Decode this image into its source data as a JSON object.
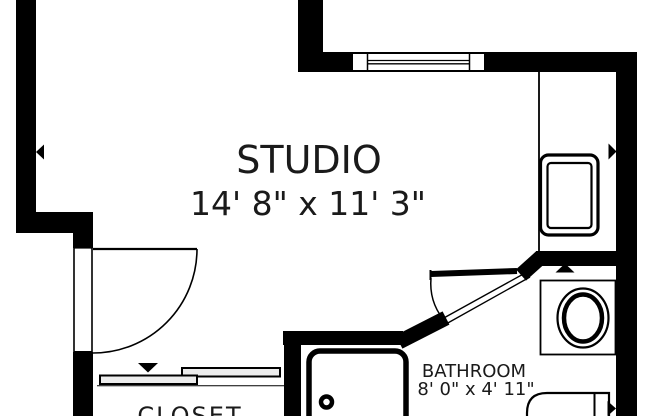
{
  "title": "Studio apartment floor plan",
  "rooms": {
    "studio": {
      "name": "STUDIO",
      "dimensions": "14' 8\" x 11' 3\""
    },
    "bathroom": {
      "name": "BATHROOM",
      "dimensions": "8' 0\" x 4' 11\""
    },
    "closet": {
      "name": "CLOSET"
    }
  },
  "fixtures": [
    "window",
    "entry-swing-door",
    "closet-sliding-doors",
    "bathroom-swing-door",
    "bathtub",
    "sink-vanity",
    "toilet",
    "utility-unit"
  ],
  "markers": [
    "left-wall-arrow",
    "right-wall-arrow",
    "bathroom-wall-arrow",
    "closet-arrow",
    "lower-right-arrow"
  ],
  "colors": {
    "wall": "#000000",
    "text": "#1a1a1a",
    "background": "#ffffff",
    "door_panel": "#ededed"
  }
}
